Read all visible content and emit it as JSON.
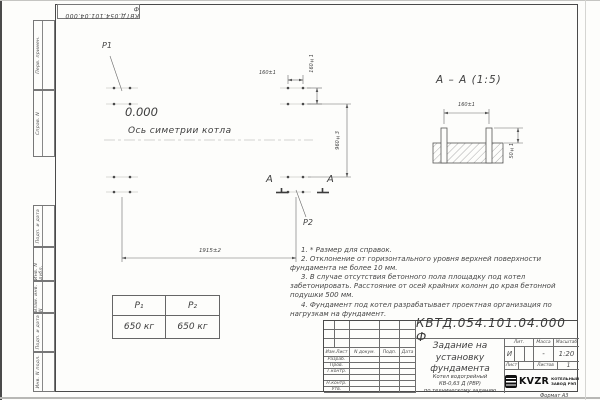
{
  "colors": {
    "paper": "#fdfdfb",
    "ink": "#3d3d3d",
    "logo_black": "#111111"
  },
  "corner_stamp": {
    "number": "КВТД.054.101.04.000 Ф"
  },
  "side_strip": {
    "labels": [
      "Перв. примен.",
      "Справ. N",
      "Подп. и дата",
      "Инв. N дубл.",
      "Взам. инв. N",
      "Подп. и дата",
      "Инв. N подл."
    ]
  },
  "plan_view": {
    "p1_label": "P1",
    "p2_label": "P2",
    "elevation": "0.000",
    "axis_label": "Ось симетрии котла",
    "dim_length": "1915±2",
    "dim_bolt_pitch_h": "160±1",
    "dim_bolt_pitch_v": "160±1",
    "dim_width": "960±3",
    "section_letter": "А"
  },
  "section_view": {
    "title": "А – А (1:5)",
    "dim_bolt_pitch": "160±1",
    "dim_protrusion": "50±1"
  },
  "notes": [
    "1. * Размер для справок.",
    "2. Отклонение от горизонтального уровня верхней поверхности фундамента не более 10 мм.",
    "3. В случае отсутствия бетонного пола площадку под котел забетонировать. Расстояние от осей крайних колонн до края бетонной подушки 500 мм.",
    "4. Фундамент под котел разрабатывает проектная организация по нагрузкам на фундамент."
  ],
  "load_table": {
    "headers": [
      "P₁",
      "P₂"
    ],
    "values": [
      "650 кг",
      "650 кг"
    ]
  },
  "title_block": {
    "number": "КВТД.054.101.04.000 Ф",
    "title": "Задание на\nустановку\nфундамента",
    "subtitle": "Котел водогрейный\nКВ-0,63 Д (РВР)\nпо техническому заданию",
    "header_cols": [
      "Изм.Лист",
      "N докум.",
      "Подп.",
      "Дата"
    ],
    "rows": [
      "Разраб.",
      "Пров.",
      "Т.контр.",
      "",
      "Н.контр.",
      "Утв."
    ],
    "lit_label": "Лит.",
    "lit_value": "И",
    "mass_label": "Масса",
    "mass_value": "-",
    "scale_label": "Масштаб",
    "scale_value": "1:20",
    "sheet_label": "Лист",
    "sheets_label": "Листов",
    "sheets_value": "1",
    "logo_text": "KVZR",
    "logo_caption": "КОТЕЛЬНЫЙ\nЗАВОД РЭП",
    "format_label": "Формат А3"
  }
}
